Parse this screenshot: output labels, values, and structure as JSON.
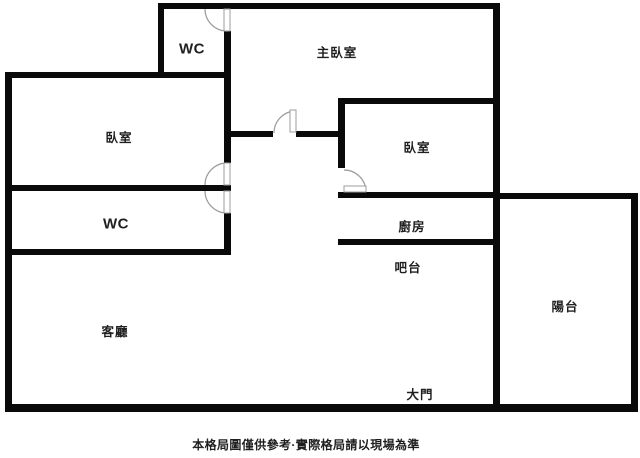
{
  "rooms": {
    "wc_top": {
      "label": "WC"
    },
    "master_bedroom": {
      "label": "主臥室"
    },
    "bedroom_left": {
      "label": "臥室"
    },
    "bedroom_right": {
      "label": "臥室"
    },
    "wc_lower": {
      "label": "WC"
    },
    "kitchen": {
      "label": "廚房"
    },
    "bar_counter": {
      "label": "吧台"
    },
    "living_room": {
      "label": "客廳"
    },
    "balcony": {
      "label": "陽台"
    },
    "main_entrance": {
      "label": "大門"
    }
  },
  "caption": {
    "text": "本格局圖僅供參考·實際格局請以現場為準"
  },
  "colors": {
    "background": "#ffffff",
    "wall": "#0a0a0a",
    "door-arc": "#9c9c9c",
    "text": "#1f1f1f"
  }
}
